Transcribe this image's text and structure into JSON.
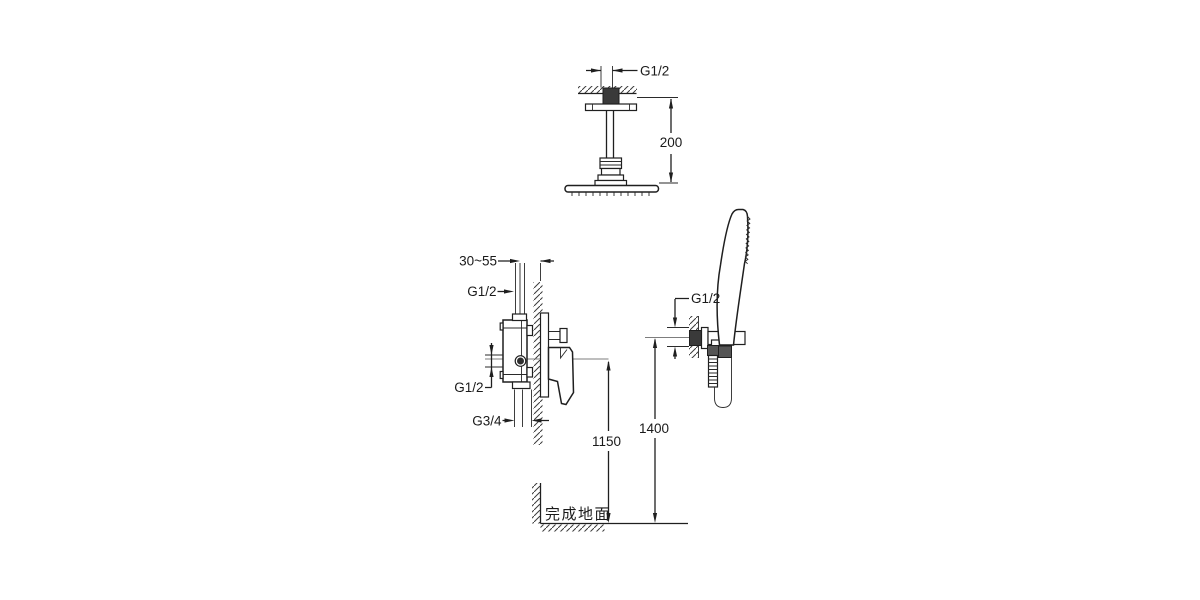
{
  "drawing": {
    "kind": "shower-system-installation-diagram",
    "colors": {
      "line": "#1f1f1f",
      "centerline": "#7d7d7d",
      "hatch": "#3c3c3c",
      "section_fill": "#3a3a3a",
      "background": "#ffffff"
    },
    "ceiling_shower": {
      "thread": "G1/2",
      "arm_drop": "200"
    },
    "mixer": {
      "embed_depth": "30~55",
      "top_thread": "G1/2",
      "outlet_thread": "G1/2",
      "inlet_thread": "G3/4",
      "mount_height": "1150"
    },
    "hand_shower": {
      "thread": "G1/2",
      "mount_height": "1400"
    },
    "floor": {
      "label": "完成地面"
    }
  }
}
